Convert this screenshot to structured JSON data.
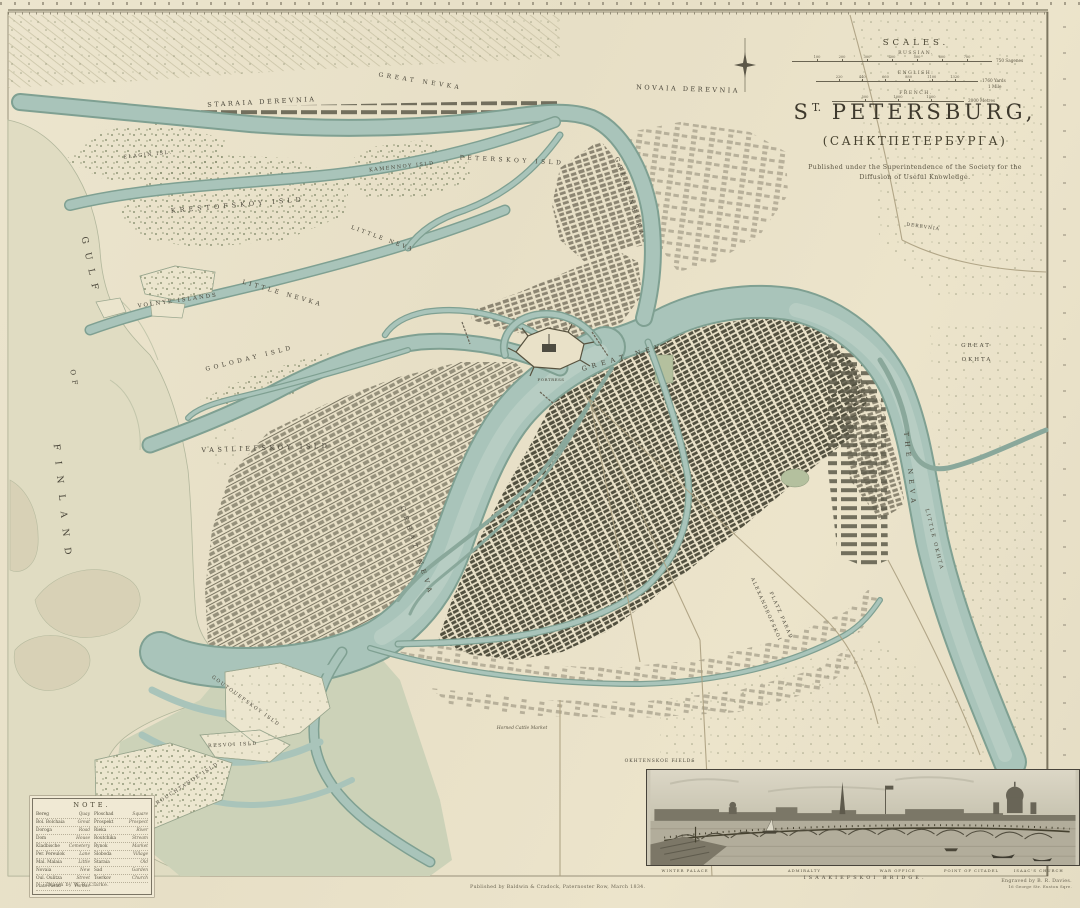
{
  "palette": {
    "paper": "#eae3cc",
    "water": "#a9c4ba",
    "water_edge": "#7fa092",
    "gulf": "#e0dcc2",
    "ink": "#4c483a"
  },
  "title": {
    "prefix": "S",
    "sup": "T.",
    "rest": "PETERSBURG,",
    "cyrillic": "(САНКТПЕТЕРБУРГА)",
    "pub_line1": "Published under the Superintendence of the Society for the",
    "pub_line2": "Diffusion of Useful Knowledge."
  },
  "scales": {
    "heading": "SCALES.",
    "bars": [
      {
        "label": "RUSSIAN.",
        "x": 0,
        "w": 200,
        "ticks": [
          "100",
          "200",
          "300",
          "400",
          "500",
          "600",
          "700"
        ],
        "end": "750 Sagenes"
      },
      {
        "label": "ENGLISH.",
        "x": 24,
        "w": 162,
        "ticks": [
          "220",
          "440",
          "660",
          "880",
          "1100",
          "1320"
        ],
        "end": "1760 Yards",
        "end2": "1 Mile"
      },
      {
        "label": "FRENCH.",
        "x": 40,
        "w": 132,
        "ticks": [
          "500",
          "1000",
          "1500"
        ],
        "end": "2000 Metres"
      }
    ]
  },
  "note": {
    "heading": "NOTE.",
    "col1": [
      [
        "Bereg",
        "Quay"
      ],
      [
        "Bol. Bolchaia",
        "Great"
      ],
      [
        "Doroga",
        "Road"
      ],
      [
        "Dom",
        "House"
      ],
      [
        "Kladbische",
        "Cemetery"
      ],
      [
        "Per. Pereulok",
        "Lane"
      ],
      [
        "Mal. Malaia",
        "Little"
      ],
      [
        "Novaia",
        "New"
      ],
      [
        "Oul. Oulitza",
        "Street"
      ],
      [
        "Plats Parad",
        "Parade"
      ]
    ],
    "col2": [
      [
        "Ploschad",
        "Square"
      ],
      [
        "Prospekt",
        "Prospect"
      ],
      [
        "Rieka",
        "River"
      ],
      [
        "Routchika",
        "Stream"
      ],
      [
        "Rynok",
        "Market"
      ],
      [
        "Sloboda",
        "Village"
      ],
      [
        "Staraia",
        "Old"
      ],
      [
        "Sad",
        "Garden"
      ],
      [
        "Tserkov",
        "Church"
      ]
    ]
  },
  "credits": {
    "drawn": "Drawn by W. B. Clarke.",
    "published": "Published by Baldwin & Cradock, Paternoster Row, March 1834.",
    "engraved": "Engraved by B. R. Davies.",
    "engraved_sub": "16 George Str. Euston Sqre."
  },
  "panorama": {
    "labels": [
      {
        "text": "WINTER PALACE",
        "x": 9
      },
      {
        "text": "ADMIRALTY",
        "x": 36.5
      },
      {
        "text": "WAR OFFICE",
        "x": 58
      },
      {
        "text": "POINT OF CITADEL",
        "x": 75
      },
      {
        "text": "ISAAC'S CHURCH",
        "x": 90.5
      }
    ],
    "caption": "ISAAKIEFSKOI  BRIDGE."
  },
  "map_labels": [
    {
      "t": "STARAIA  DEREVNIA",
      "x": 262,
      "y": 104,
      "r": -3,
      "s": 6.5,
      "sp": 2.5
    },
    {
      "t": "NOVAIA  DEREVNIA",
      "x": 688,
      "y": 91,
      "r": 2,
      "s": 6.5,
      "sp": 2.5
    },
    {
      "t": "GREAT  NEVKA",
      "x": 420,
      "y": 83,
      "r": 9,
      "s": 6,
      "sp": 3.5
    },
    {
      "t": "GREAT  NEVKA",
      "x": 628,
      "y": 198,
      "r": 72,
      "s": 6,
      "sp": 3.5
    },
    {
      "t": "ELAGIN ISL.",
      "x": 148,
      "y": 156,
      "r": -6,
      "s": 5,
      "sp": 1.5
    },
    {
      "t": "KRESTOFSKOY  ISLD",
      "x": 238,
      "y": 207,
      "r": -5,
      "s": 6.5,
      "sp": 4
    },
    {
      "t": "KAMENNOY ISLD",
      "x": 402,
      "y": 168,
      "r": -6,
      "s": 5,
      "sp": 1.5
    },
    {
      "t": "PETERSKOY  ISLD",
      "x": 512,
      "y": 162,
      "r": 3,
      "s": 6,
      "sp": 3.5
    },
    {
      "t": "LITTLE  NEVKA",
      "x": 282,
      "y": 295,
      "r": 16,
      "s": 6,
      "sp": 3
    },
    {
      "t": "LITTLE  NEVA",
      "x": 382,
      "y": 240,
      "r": 20,
      "s": 5.5,
      "sp": 2.5
    },
    {
      "t": "VOLNYE  ISLANDS",
      "x": 178,
      "y": 302,
      "r": -8,
      "s": 5.5,
      "sp": 2
    },
    {
      "t": "GOLODAY  ISLD",
      "x": 250,
      "y": 360,
      "r": -14,
      "s": 6,
      "sp": 3.5
    },
    {
      "t": "VASILIEFSKOY  ISLD",
      "x": 266,
      "y": 450,
      "r": -2,
      "s": 6.5,
      "sp": 3.5
    },
    {
      "t": "GULF",
      "x": 88,
      "y": 268,
      "r": 78,
      "s": 9,
      "sp": 9
    },
    {
      "t": "OF",
      "x": 72,
      "y": 380,
      "r": 80,
      "s": 7,
      "sp": 5
    },
    {
      "t": "FINLAND",
      "x": 60,
      "y": 505,
      "r": 84,
      "s": 9,
      "sp": 11
    },
    {
      "t": "GREAT  NEVA",
      "x": 628,
      "y": 358,
      "r": -16,
      "s": 6.5,
      "sp": 5
    },
    {
      "t": "GREAT  NEVA",
      "x": 415,
      "y": 552,
      "r": 72,
      "s": 6.5,
      "sp": 5
    },
    {
      "t": "THE  NEVA",
      "x": 908,
      "y": 470,
      "r": 84,
      "s": 6.5,
      "sp": 5
    },
    {
      "t": "LITTLE OKHTA",
      "x": 933,
      "y": 540,
      "r": 76,
      "s": 5,
      "sp": 2
    },
    {
      "t": "GREAT",
      "x": 976,
      "y": 347,
      "r": 0,
      "s": 5.5,
      "sp": 2
    },
    {
      "t": "OKHTA",
      "x": 977,
      "y": 361,
      "r": 0,
      "s": 5.5,
      "sp": 2
    },
    {
      "t": "DEREVNIA",
      "x": 923,
      "y": 228,
      "r": 8,
      "s": 4.5,
      "sp": 1
    },
    {
      "t": "FORTRESS",
      "x": 551,
      "y": 381,
      "r": 0,
      "s": 4,
      "sp": 0.5
    },
    {
      "t": "ALEXANDROFSKOI",
      "x": 765,
      "y": 610,
      "r": 66,
      "s": 4.8,
      "sp": 1.5
    },
    {
      "t": "PLATZ PARAD",
      "x": 780,
      "y": 616,
      "r": 66,
      "s": 4.8,
      "sp": 1.5
    },
    {
      "t": "GOUTOUEFSKOY ISLD",
      "x": 245,
      "y": 702,
      "r": 36,
      "s": 4.8,
      "sp": 1.5
    },
    {
      "t": "RESVOI ISLD",
      "x": 233,
      "y": 746,
      "r": -3,
      "s": 4.8,
      "sp": 1.5
    },
    {
      "t": "TROUCHTANOE ISLD",
      "x": 186,
      "y": 786,
      "r": -33,
      "s": 4.8,
      "sp": 1.5
    },
    {
      "t": "Horned Cattle Market",
      "x": 522,
      "y": 729,
      "r": 0,
      "s": 4.5,
      "sp": 0,
      "i": true
    },
    {
      "t": "OKHTENSKOE FIELDS",
      "x": 660,
      "y": 762,
      "r": 0,
      "s": 4.5,
      "sp": 1
    }
  ]
}
